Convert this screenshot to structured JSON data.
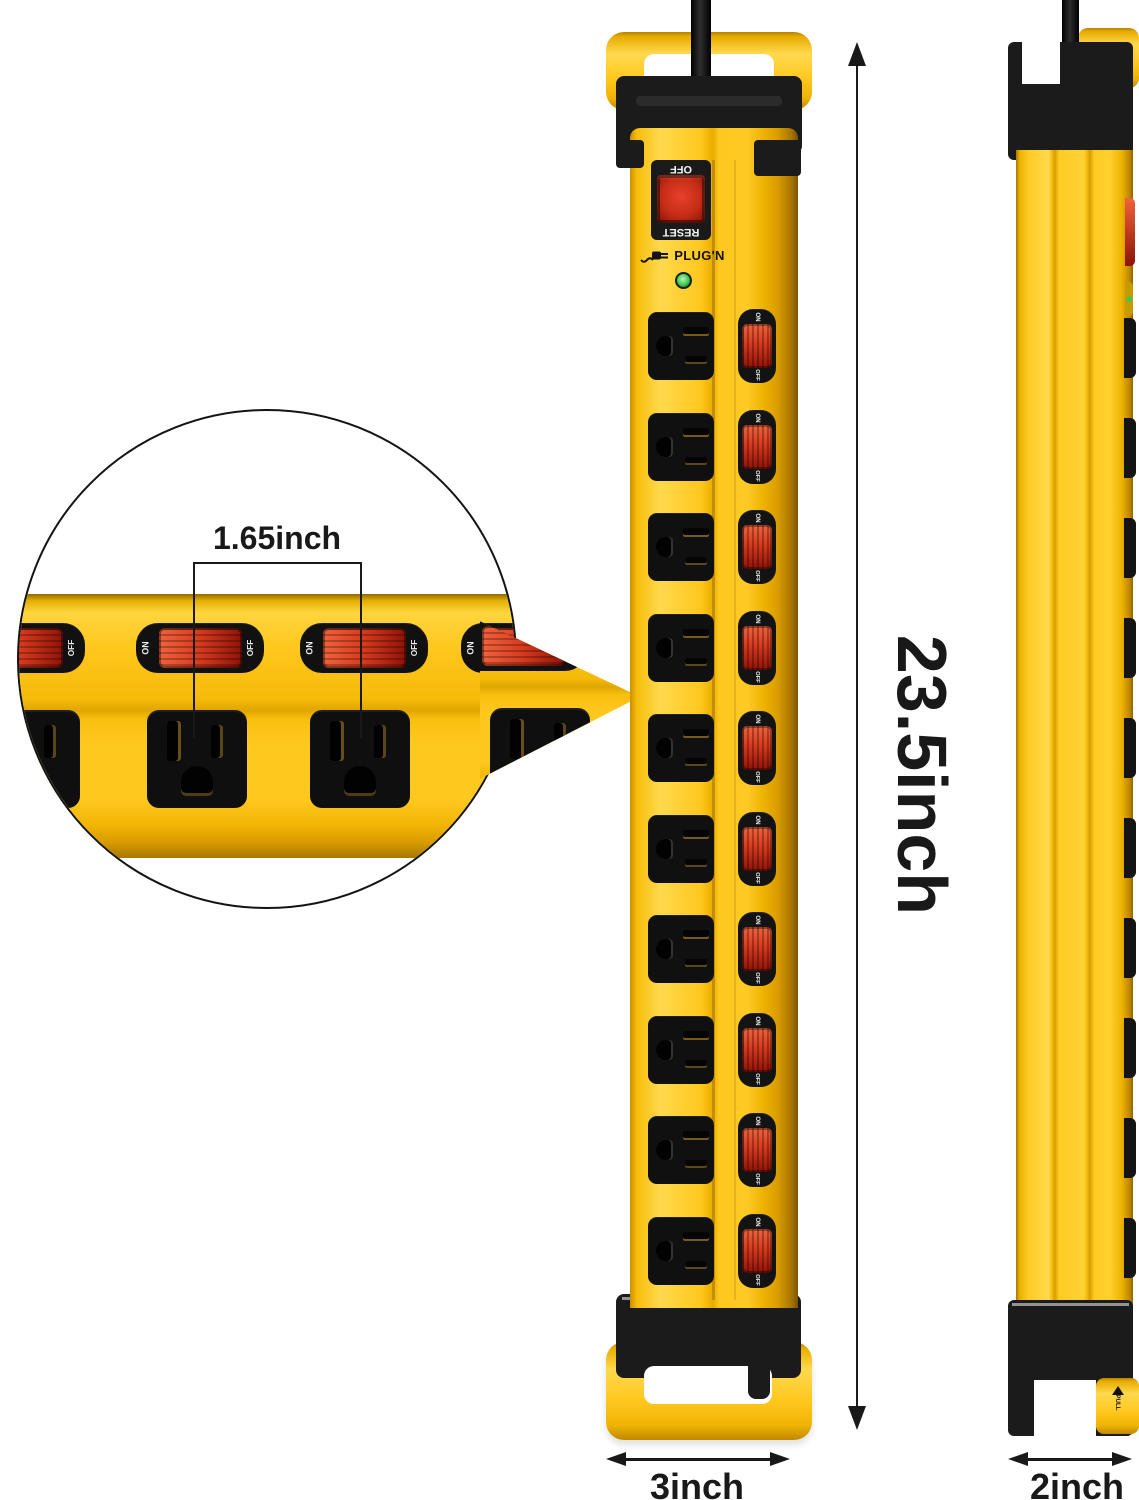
{
  "image_type": "product-dimension-diagram",
  "product": {
    "brand": "PLUG'N",
    "outlet_count": 10,
    "reset_switch": {
      "top_label": "OFF",
      "bottom_label": "RESET"
    },
    "rocker_switch": {
      "on_label": "ON",
      "off_label": "OFF"
    },
    "pull_tab_label": "PULL"
  },
  "dimensions": {
    "height_label": "23.5inch",
    "width_label": "3inch",
    "depth_label": "2inch",
    "outlet_spacing_label": "1.65inch"
  },
  "colors": {
    "yellow": "#ffc81e",
    "yellow_hi": "#ffd94e",
    "yellow_dk": "#e8ac00",
    "black": "#1b1b1b",
    "red": "#d63a1e",
    "red_hi": "#f0633c",
    "red_dk": "#8e1307",
    "green": "#41c74d",
    "ink": "#191919",
    "white": "#ffffff"
  }
}
